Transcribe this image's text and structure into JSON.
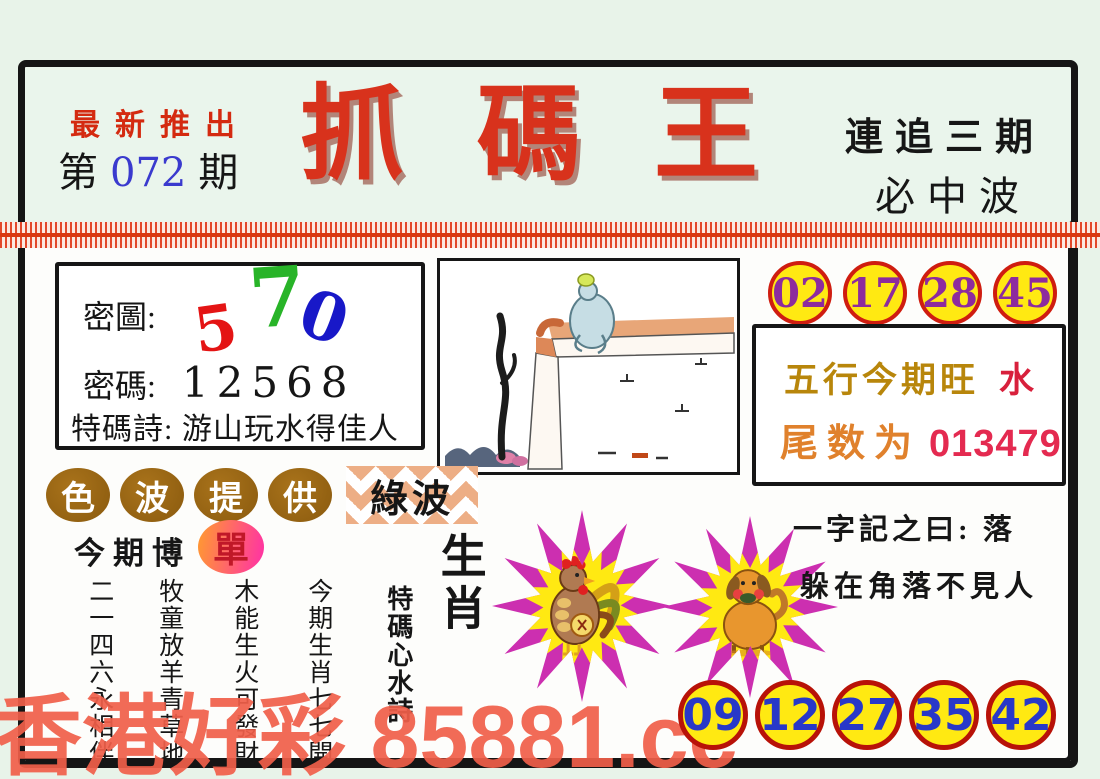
{
  "colors": {
    "background_green": "#e8f3e9",
    "title_red": "#d8321c",
    "circle_yellow": "#ffe912",
    "top_circle_border": "#cf1d10",
    "top_number_purple": "#8d2b9e",
    "bottom_circle_border": "#b81208",
    "bottom_number_blue": "#2838c8",
    "wuxing_gold": "#b8860b",
    "wuxing_red": "#d8203c",
    "tail_label_orange": "#e0812c",
    "tail_value_red": "#e42a50",
    "oval_brown": "#96610f",
    "dan_text_red": "#c01828",
    "watermark_red": "#f15f4a",
    "star_outline_magenta": "#cc2fb0"
  },
  "header": {
    "promo": "最新推出",
    "issue_prefix": "第",
    "issue_number": "072",
    "issue_suffix": "期",
    "title_chars": [
      "抓",
      "碼",
      "王"
    ],
    "chase_text": "連追三期",
    "wave_text": "必中波"
  },
  "secret_box": {
    "map_label": "密圖:",
    "map_glyphs": [
      {
        "char": "5",
        "color": "#e41414"
      },
      {
        "char": "7",
        "color": "#28b428"
      },
      {
        "char": "0",
        "color": "#1818c8"
      }
    ],
    "code_label": "密碼:",
    "code_value": "12568",
    "poem_label": "特碼詩:",
    "poem_text": "游山玩水得佳人"
  },
  "center_picture": "frog-sitting-on-wall-watercolor",
  "top_numbers": [
    "02",
    "17",
    "28",
    "45"
  ],
  "wuxing_box": {
    "line1_label": "五行今期旺",
    "line1_value": "水",
    "line2_label": "尾数为",
    "line2_value": "013479"
  },
  "sebo": {
    "oval_chars": [
      "色",
      "波",
      "提",
      "供"
    ],
    "wave_value": "綠波"
  },
  "bet": {
    "label": "今期博",
    "value": "單"
  },
  "zodiac_section": {
    "heading": "生肖",
    "poem_title": "特碼心水詩",
    "poem_lines": [
      "今期生肖七七開",
      "木能生火可發財",
      "牧童放羊青草地",
      "二一四六永相伴"
    ],
    "animals": [
      "rooster",
      "dog"
    ]
  },
  "riddle": {
    "line1": "一字記之曰: 落",
    "line2": "躲在角落不見人"
  },
  "bottom_numbers": [
    "09",
    "12",
    "27",
    "35",
    "42"
  ],
  "watermark": "香港好彩 85881.cc"
}
